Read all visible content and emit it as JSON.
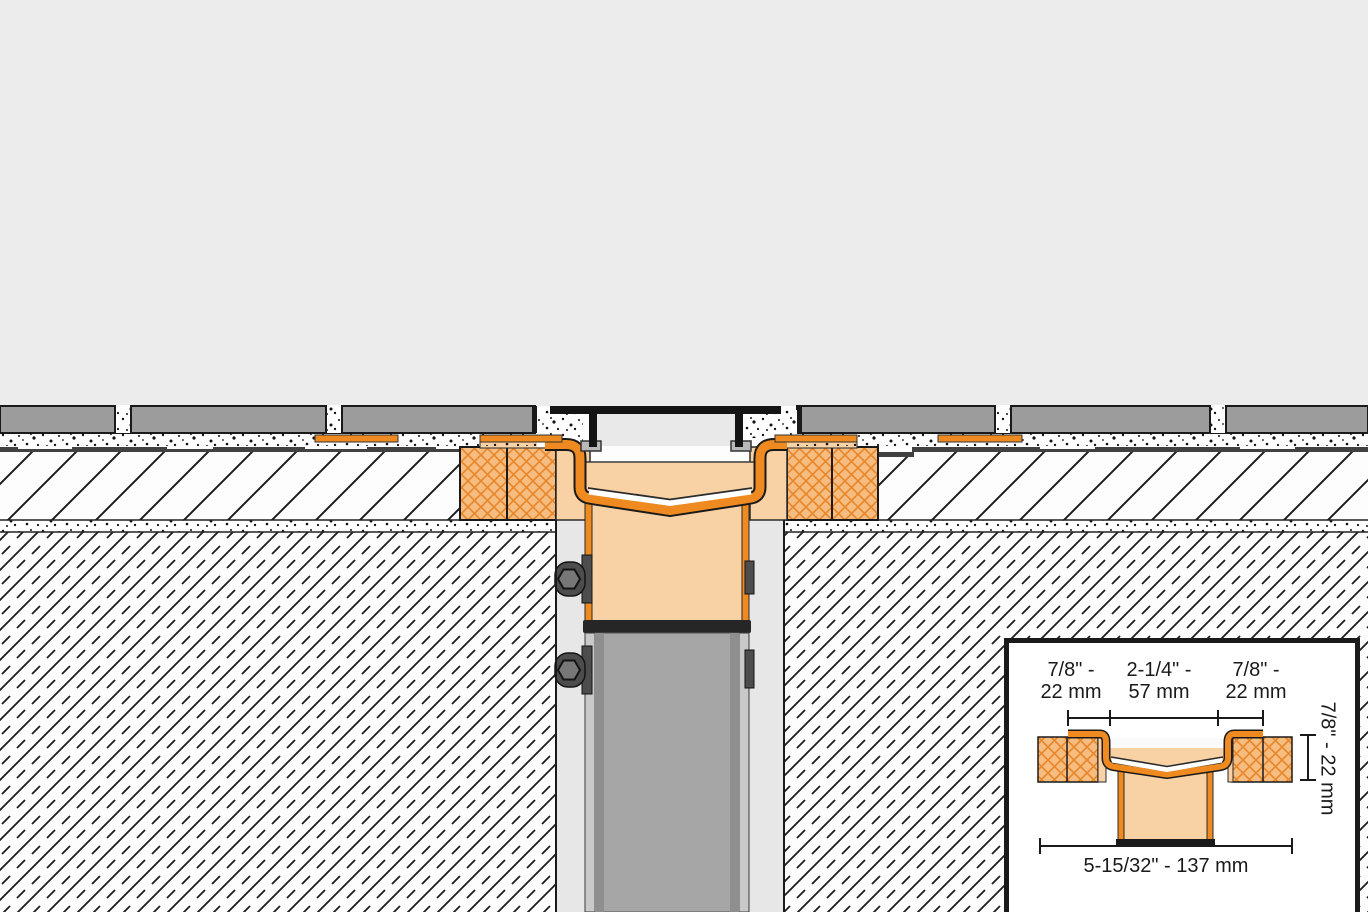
{
  "drawing_title": "Linear drain vertical-outlet installation cross-section",
  "inset": {
    "top_left": {
      "line1": "7/8\" -",
      "line2": "22 mm"
    },
    "top_center": {
      "line1": "2-1/4\" -",
      "line2": "57 mm"
    },
    "top_right": {
      "line1": "7/8\" -",
      "line2": "22 mm"
    },
    "right_vertical": "7/8\" - 22 mm",
    "bottom": "5-15/32\" - 137 mm"
  },
  "colors": {
    "background": "#ececec",
    "tile_gray": "#9c9c9c",
    "membrane_orange": "#ee8a1f",
    "drain_body_peach": "#f8d2a5",
    "board_crosshatch_bg": "#f6bc80",
    "board_crosshatch_line": "#e8862a",
    "outline_black": "#1a1a1a",
    "pipe_gray": "#a6a6a6",
    "bracket_gray": "#4d4d4d",
    "foot_gray": "#b8b8b8",
    "void_gray": "#e7e7e7"
  }
}
